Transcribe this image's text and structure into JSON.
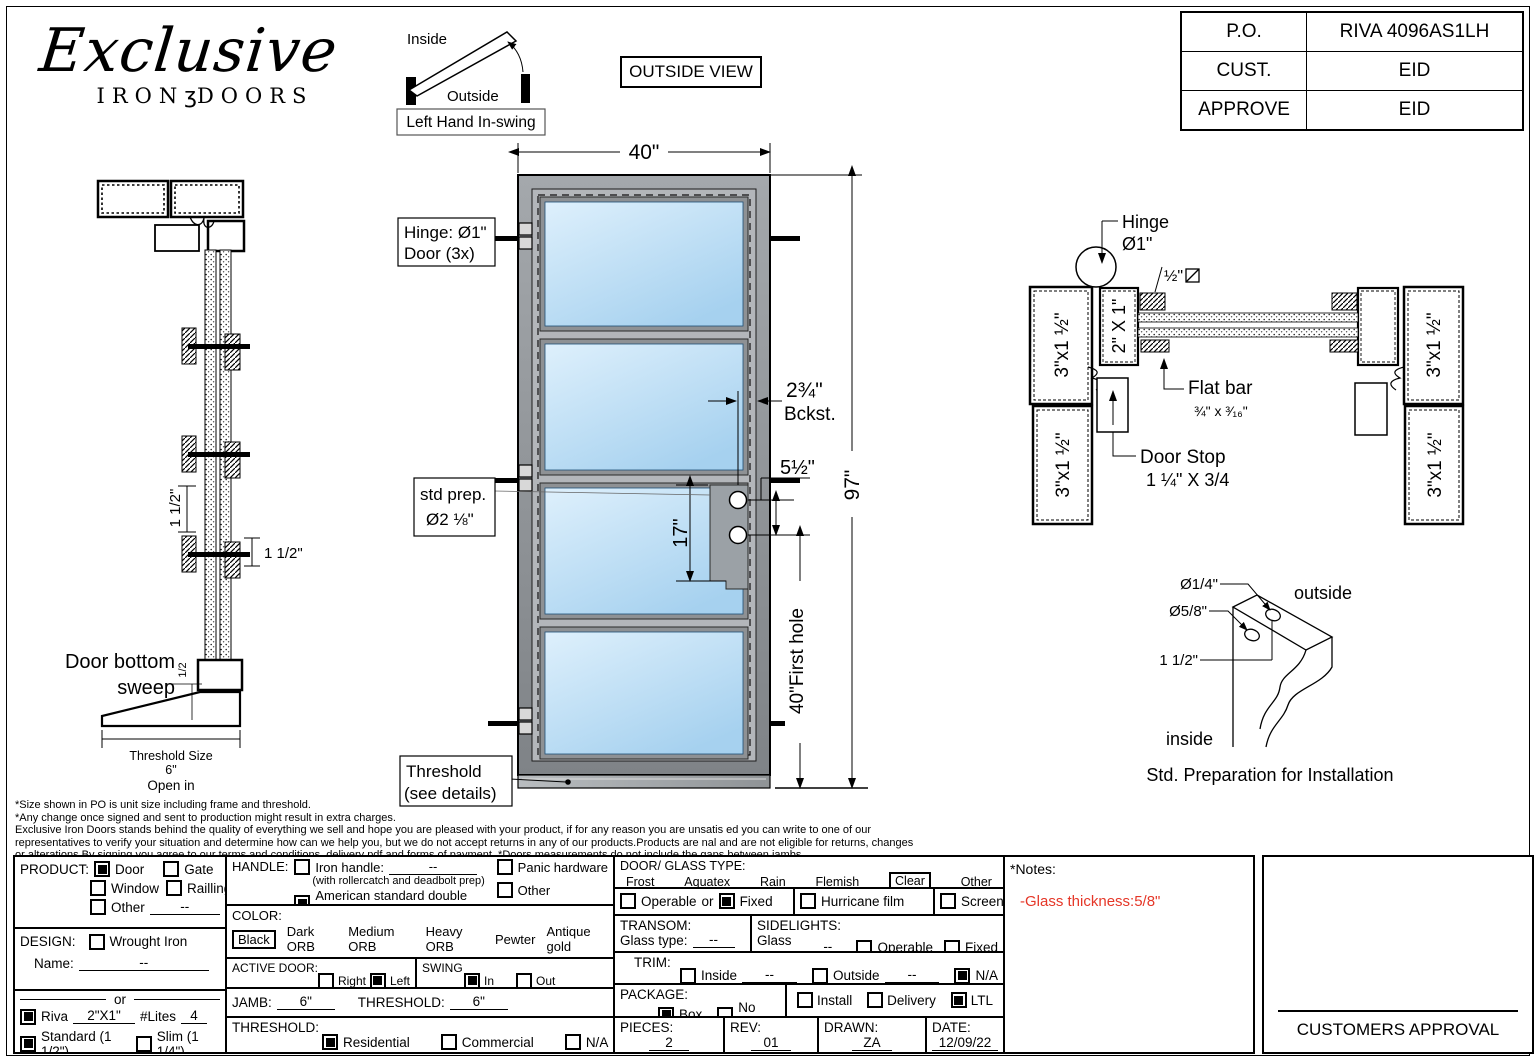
{
  "logo": {
    "name": "Exclusive",
    "word_left": "IRON",
    "ornament": "ʒ",
    "word_right": "DOORS"
  },
  "swing_diagram": {
    "inside_label": "Inside",
    "outside_label": "Outside",
    "caption": "Left Hand In-swing"
  },
  "view_label": "OUTSIDE VIEW",
  "title_block": {
    "rows": [
      {
        "label": "P.O.",
        "value": "RIVA 4096AS1LH"
      },
      {
        "label": "CUST.",
        "value": "EID"
      },
      {
        "label": "APPROVE",
        "value": "EID"
      }
    ]
  },
  "door_drawing": {
    "width_dim": "40\"",
    "height_dim": "97\"",
    "hinge_callout": {
      "line1": "Hinge: Ø1\"",
      "line2": "Door (3x)"
    },
    "std_prep": {
      "line1": "std prep.",
      "line2": "Ø2 ⅛\""
    },
    "threshold_callout": {
      "line1": "Threshold",
      "line2": "(see details)"
    },
    "backset_dim": "2¾\"",
    "backset_label": "Bckst.",
    "hole_spacing_dim": "5½\"",
    "lock_height_dim": "17\"",
    "first_hole_dim": "40\"First hole"
  },
  "jamb_section": {
    "glazing_dim_v": "1 1/2\"",
    "glazing_dim_h": "1 1/2\"",
    "sweep_label_line1": "Door bottom",
    "sweep_label_line2": "sweep",
    "sweep_dim": "1/2",
    "threshold_size_line1": "Threshold Size",
    "threshold_size_line2": "6\"",
    "threshold_size_line3": "Open in"
  },
  "plan_section": {
    "hinge_label": "Hinge",
    "hinge_dia": "Ø1\"",
    "square_bar_dim": "½\"",
    "jamb_profile": "3\"x1 ½\"",
    "stile_profile": "2\" X 1\"",
    "flat_bar_label": "Flat bar",
    "flat_bar_size": "¾\" x ³⁄₁₆\"",
    "door_stop_label": "Door Stop",
    "door_stop_size": "1 ¼\" X 3/4"
  },
  "install_detail": {
    "hole_small": "Ø1/4\"",
    "hole_large": "Ø5/8\"",
    "edge_dist": "1 1/2\"",
    "outside_label": "outside",
    "inside_label": "inside",
    "caption": "Std. Preparation for Installation"
  },
  "disclaimer": {
    "line1": "*Size shown in PO is unit size including frame and threshold.",
    "line2": "*Any change once signed and sent to production might result in extra charges.",
    "line3": "Exclusive Iron Doors stands behind the quality of everything we sell and hope you are pleased with your product, if for any reason you are unsatis   ed you can write to one of our",
    "line4": "representatives to verify your situation and determine how can we help you, but we do not accept returns in any of our products.Products are   nal and are not eligible for returns, changes",
    "line5": "or alterations.By signing you agree to our terms and conditions, delivery pdf and forms of payment.  *Doors measurements do not include the gaps between jambs"
  },
  "form": {
    "product": {
      "label": "PRODUCT:",
      "door": "Door",
      "gate": "Gate",
      "window": "Window",
      "railing": "Railling",
      "other": "Other",
      "other_value": "--",
      "selected": "Door"
    },
    "design": {
      "label": "DESIGN:",
      "wrought_iron": "Wrought Iron",
      "name_label": "Name:",
      "name_value": "--",
      "or_label": "or"
    },
    "riva": {
      "label": "Riva",
      "profile_value": "2\"X1\"",
      "lites_label": "#Lites",
      "lites_value": "4",
      "standard": "Standard (1 1/2\")",
      "slim": "Slim (1 1/4\")",
      "selected": "Riva, Standard"
    },
    "handle": {
      "label": "HANDLE:",
      "iron_handle": "Iron handle:",
      "iron_value": "--",
      "iron_note": "(with rollercatch and deadbolt prep)",
      "american": "American standard double boring",
      "panic": "Panic hardware",
      "other": "Other",
      "selected": "American standard double boring"
    },
    "color": {
      "label": "COLOR:",
      "black": "Black",
      "dark_orb": "Dark ORB",
      "medium_orb": "Medium ORB",
      "heavy_orb": "Heavy ORB",
      "pewter": "Pewter",
      "antique_gold": "Antique gold",
      "cerakote": "Cerakote",
      "custom": "Custom",
      "selected": "Black"
    },
    "active_door": {
      "label": "ACTIVE DOOR:",
      "right": "Right",
      "left": "Left",
      "selected": "Left"
    },
    "swing": {
      "label": "SWING",
      "in": "In",
      "out": "Out",
      "selected": "In"
    },
    "jamb": {
      "label": "JAMB:",
      "value": "6\""
    },
    "threshold_size": {
      "label": "THRESHOLD:",
      "value": "6\""
    },
    "threshold": {
      "label": "THRESHOLD:",
      "residential": "Residential",
      "commercial": "Commercial",
      "na": "N/A",
      "selected": "Residential"
    },
    "glass": {
      "label": "DOOR/ GLASS TYPE:",
      "frost": "Frost",
      "aquatex": "Aquatex",
      "rain": "Rain",
      "flemish": "Flemish",
      "clear": "Clear",
      "other": "Other",
      "selected": "Clear"
    },
    "operation": {
      "operable": "Operable",
      "or_label": "or",
      "fixed": "Fixed",
      "hurricane": "Hurricane film",
      "screen": "Screen",
      "selected": "Fixed"
    },
    "transom": {
      "label": "TRANSOM:",
      "glass_type_label": "Glass type:",
      "value": "--"
    },
    "sidelights": {
      "label": "SIDELIGHTS:",
      "glass_type_label": "Glass type:",
      "value": "--",
      "operable": "Operable",
      "fixed": "Fixed"
    },
    "trim": {
      "label": "TRIM:",
      "inside": "Inside",
      "inside_value": "--",
      "outside": "Outside",
      "outside_value": "--",
      "na": "N/A",
      "selected": "N/A"
    },
    "package": {
      "label": "PACKAGE:",
      "box": "Box",
      "no_box": "No box",
      "install": "Install",
      "delivery": "Delivery",
      "ltl": "LTL",
      "selected": "Box, LTL"
    },
    "pieces": {
      "label": "PIECES:",
      "value": "2"
    },
    "rev": {
      "label": "REV:",
      "value": "01"
    },
    "drawn": {
      "label": "DRAWN:",
      "value": "ZA"
    },
    "date": {
      "label": "DATE:",
      "value": "12/09/22"
    }
  },
  "notes": {
    "label": "*Notes:",
    "note": "-Glass thickness:5/8\"",
    "note_color": "#e53728"
  },
  "approval": {
    "label": "CUSTOMERS APPROVAL"
  }
}
